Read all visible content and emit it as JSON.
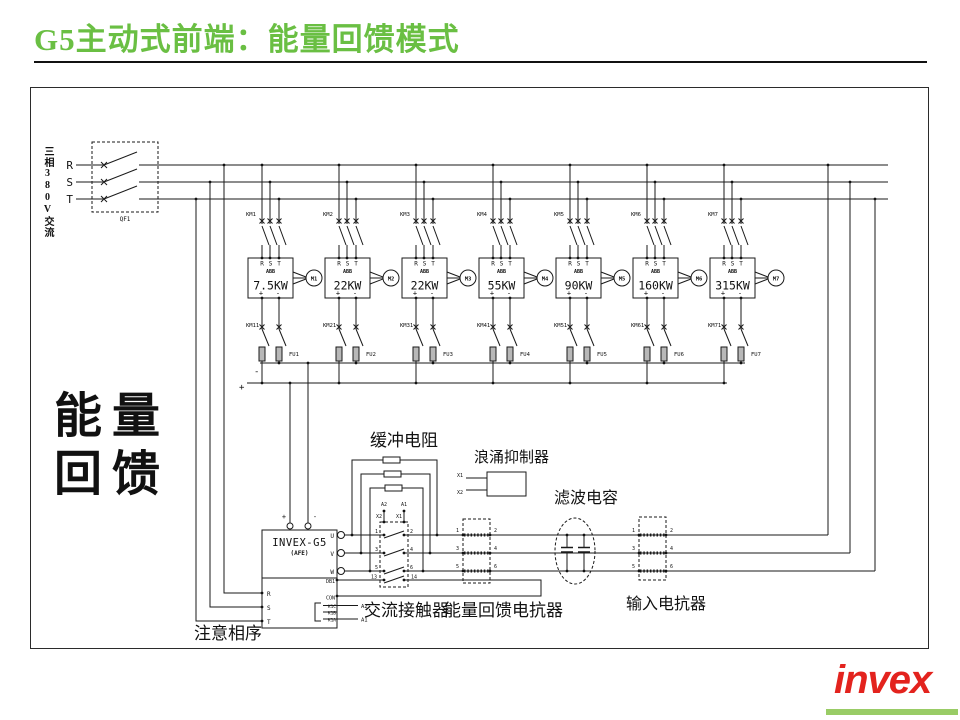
{
  "title": "G5主动式前端：能量回馈模式",
  "colors": {
    "title_green": "#6abf43",
    "logo_red": "#e3231e",
    "logo_underline_green": "#99cc66"
  },
  "supply": {
    "source_label": "三相380V交流",
    "phase_labels": [
      "R",
      "S",
      "T"
    ],
    "breaker_label": "QF1"
  },
  "feedback_label": {
    "line1": "能量",
    "line2": "回馈"
  },
  "dc_bus": {
    "plus": "+",
    "minus": "-"
  },
  "drives": [
    {
      "contactor": "KM1",
      "brake_contactor": "KM11",
      "fuse": "FU1",
      "brand": "ABB",
      "terminals": [
        "R",
        "S",
        "T"
      ],
      "power": "7.5KW",
      "motor": "M1",
      "dc_plus": "+",
      "dc_minus": "-"
    },
    {
      "contactor": "KM2",
      "brake_contactor": "KM21",
      "fuse": "FU2",
      "brand": "ABB",
      "terminals": [
        "R",
        "S",
        "T"
      ],
      "power": "22KW",
      "motor": "M2",
      "dc_plus": "+",
      "dc_minus": "-"
    },
    {
      "contactor": "KM3",
      "brake_contactor": "KM31",
      "fuse": "FU3",
      "brand": "ABB",
      "terminals": [
        "R",
        "S",
        "T"
      ],
      "power": "22KW",
      "motor": "M3",
      "dc_plus": "+",
      "dc_minus": "-"
    },
    {
      "contactor": "KM4",
      "brake_contactor": "KM41",
      "fuse": "FU4",
      "brand": "ABB",
      "terminals": [
        "R",
        "S",
        "T"
      ],
      "power": "55KW",
      "motor": "M4",
      "dc_plus": "+",
      "dc_minus": "-"
    },
    {
      "contactor": "KM5",
      "brake_contactor": "KM51",
      "fuse": "FU5",
      "brand": "ABB",
      "terminals": [
        "R",
        "S",
        "T"
      ],
      "power": "90KW",
      "motor": "M5",
      "dc_plus": "+",
      "dc_minus": "-"
    },
    {
      "contactor": "KM6",
      "brake_contactor": "KM61",
      "fuse": "FU6",
      "brand": "ABB",
      "terminals": [
        "R",
        "S",
        "T"
      ],
      "power": "160KW",
      "motor": "M6",
      "dc_plus": "+",
      "dc_minus": "-"
    },
    {
      "contactor": "KM7",
      "brake_contactor": "KM71",
      "fuse": "FU7",
      "brand": "ABB",
      "terminals": [
        "R",
        "S",
        "T"
      ],
      "power": "315KW",
      "motor": "M7",
      "dc_plus": "+",
      "dc_minus": "-"
    }
  ],
  "invex": {
    "name": "INVEX-G5",
    "subtitle": "(AFE)",
    "cabinet": "(G5专用)",
    "left_terminals": [
      "R",
      "S",
      "T"
    ],
    "dc_terminals": [
      "+",
      "-"
    ],
    "right_terminals": [
      "U",
      "V",
      "W",
      "DB1",
      "CON",
      "K1C",
      "K1B",
      "K1A"
    ],
    "control_wire_labels": [
      "A2",
      "A1"
    ],
    "phase_note": "注意相序"
  },
  "components": {
    "buffer_resistor": "缓冲电阻",
    "surge_suppressor": "浪涌抑制器",
    "surge_terminals": [
      "X1",
      "X2"
    ],
    "ac_contactor": "交流接触器",
    "contactor_contact_numbers": [
      "1",
      "2",
      "3",
      "4",
      "5",
      "6",
      "13",
      "14"
    ],
    "contactor_coil_labels": [
      "A2",
      "A1",
      "X2",
      "X1"
    ],
    "regen_reactor": "能量回馈电抗器",
    "regen_reactor_terminals": [
      "1",
      "2",
      "3",
      "4",
      "5",
      "6"
    ],
    "filter_capacitor": "滤波电容",
    "input_reactor": "输入电抗器",
    "input_reactor_terminals": [
      "1",
      "2",
      "3",
      "4",
      "5",
      "6"
    ]
  },
  "logo": {
    "text": "invex"
  }
}
